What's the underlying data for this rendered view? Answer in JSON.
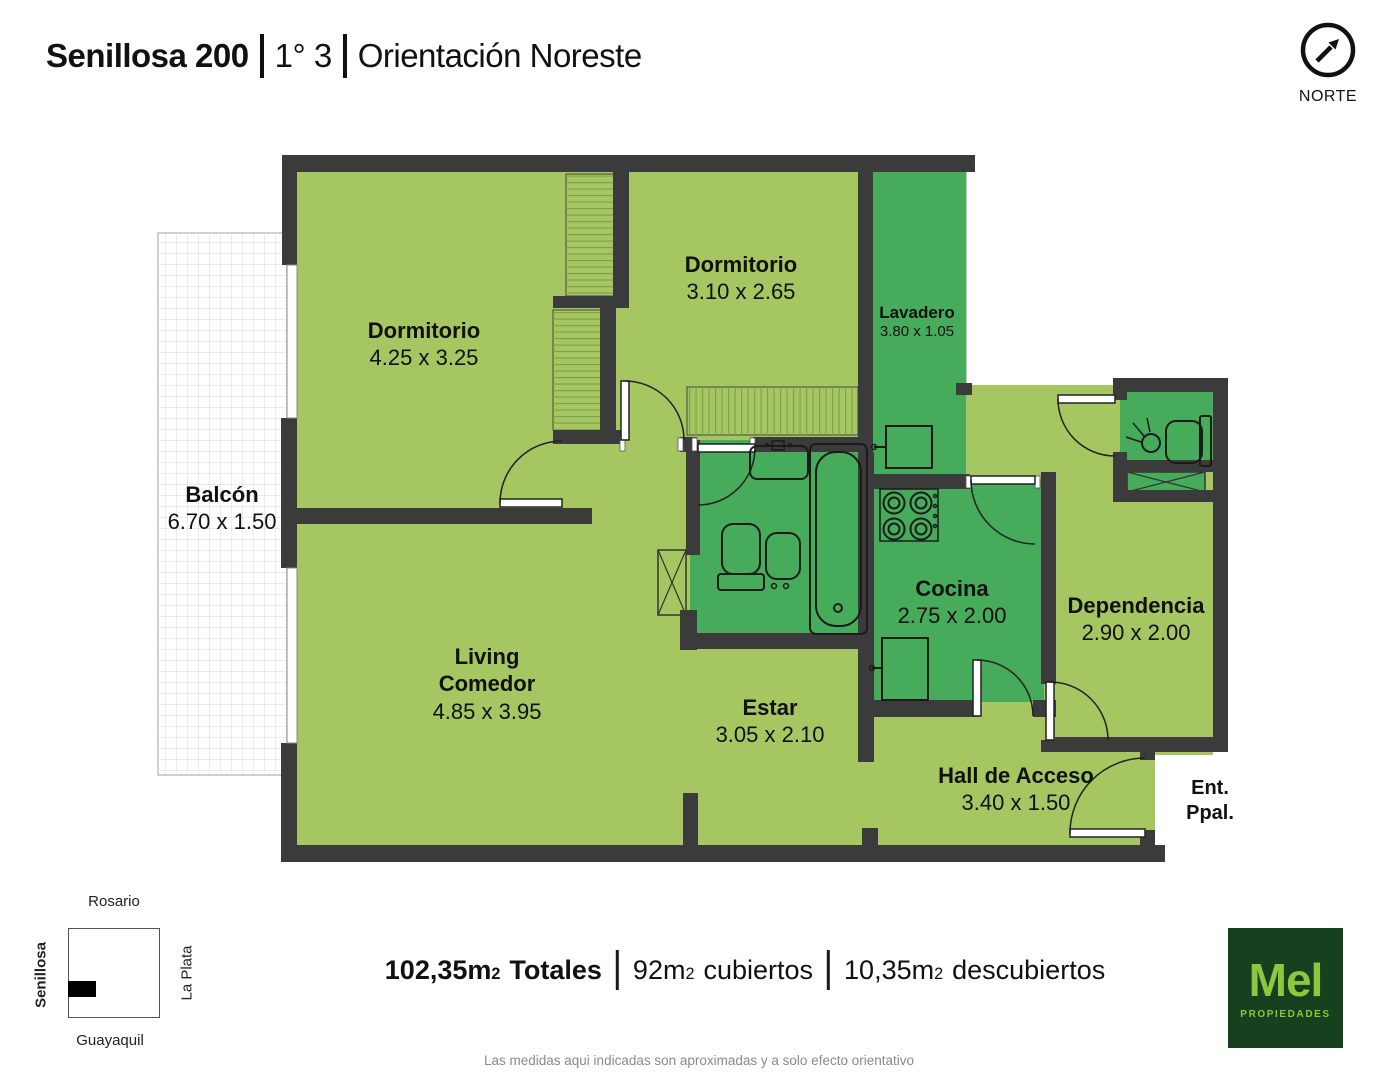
{
  "header": {
    "title_bold": "Senillosa 200",
    "title_unit": "1° 3",
    "title_orientation": "Orientación Noreste"
  },
  "north": {
    "label": "NORTE"
  },
  "floorplan": {
    "rooms": [
      {
        "label": "Dormitorio",
        "dims": "4.25 x 3.25",
        "x": 424,
        "y": 317,
        "size": 22
      },
      {
        "label": "Dormitorio",
        "dims": "3.10 x 2.65",
        "x": 741,
        "y": 251,
        "size": 22
      },
      {
        "label": "Lavadero",
        "dims": "3.80 x 1.05",
        "x": 917,
        "y": 302,
        "size": 17
      },
      {
        "label": "Balcón",
        "dims": "6.70 x 1.50",
        "x": 222,
        "y": 481,
        "size": 22
      },
      {
        "label": "Living\nComedor",
        "dims": "4.85 x 3.95",
        "x": 487,
        "y": 643,
        "size": 22
      },
      {
        "label": "Estar",
        "dims": "3.05 x 2.10",
        "x": 770,
        "y": 694,
        "size": 22
      },
      {
        "label": "Cocina",
        "dims": "2.75 x 2.00",
        "x": 952,
        "y": 575,
        "size": 22
      },
      {
        "label": "Dependencia",
        "dims": "2.90 x 2.00",
        "x": 1136,
        "y": 592,
        "size": 22
      },
      {
        "label": "Hall de Acceso",
        "dims": "3.40 x 1.50",
        "x": 1016,
        "y": 762,
        "size": 22
      },
      {
        "label": "Ent.\nPpal.",
        "dims": "",
        "x": 1210,
        "y": 776,
        "size": 20
      }
    ]
  },
  "map": {
    "top": "Rosario",
    "left": "Senillosa",
    "right": "La Plata",
    "bottom": "Guayaquil"
  },
  "footer": {
    "areas": [
      {
        "amount": "102,35m",
        "sup": "2",
        "label": "Totales"
      },
      {
        "amount": "92m",
        "sup": "2",
        "label": "cubiertos"
      },
      {
        "amount": "10,35m",
        "sup": "2",
        "label": "descubiertos"
      }
    ]
  },
  "logo": {
    "name": "Mel",
    "tagline": "PROPIEDADES"
  },
  "disclaimer": "Las medidas aqui indicadas son aproximadas y a solo efecto orientativo",
  "colors": {
    "room_light": "#a6c661",
    "room_wet": "#46ab5b",
    "wall": "#3b3b3b",
    "logo_bg": "#16401e",
    "logo_green": "#8ec63f"
  }
}
